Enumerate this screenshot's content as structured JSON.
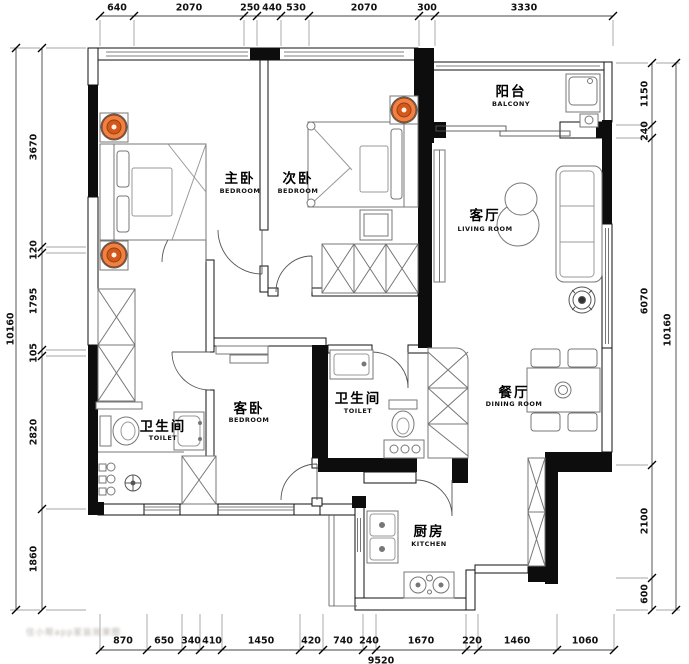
{
  "rooms": [
    {
      "zh": "主卧",
      "en": "BEDROOM"
    },
    {
      "zh": "次卧",
      "en": "BEDROOM"
    },
    {
      "zh": "阳台",
      "en": "BALCONY"
    },
    {
      "zh": "客厅",
      "en": "LIVING ROOM"
    },
    {
      "zh": "客卧",
      "en": "BEDROOM"
    },
    {
      "zh": "卫生间",
      "en": "TOILET"
    },
    {
      "zh": "卫生间",
      "en": "TOILET"
    },
    {
      "zh": "餐厅",
      "en": "DINING ROOM"
    },
    {
      "zh": "厨房",
      "en": "KITCHEN"
    }
  ],
  "dimensions": {
    "top": [
      "640",
      "2070",
      "250",
      "440",
      "530",
      "2070",
      "300",
      "3330"
    ],
    "bottom": [
      "870",
      "650",
      "340",
      "410",
      "1450",
      "420",
      "740",
      "240",
      "1670",
      "220",
      "1460",
      "1060"
    ],
    "bottom_total": "9520",
    "left": [
      "3670",
      "120",
      "1795",
      "105",
      "2820",
      "1860"
    ],
    "left_total": "10160",
    "right": [
      "1150",
      "240",
      "6070",
      "2100",
      "600"
    ],
    "right_total": "10160"
  },
  "watermark": "住小帮app家装效果图",
  "colors": {
    "wall": "#0d0d0d",
    "line": "#444444",
    "accent_orange": "#ef8146",
    "accent_orange_dark": "#d2591b"
  }
}
